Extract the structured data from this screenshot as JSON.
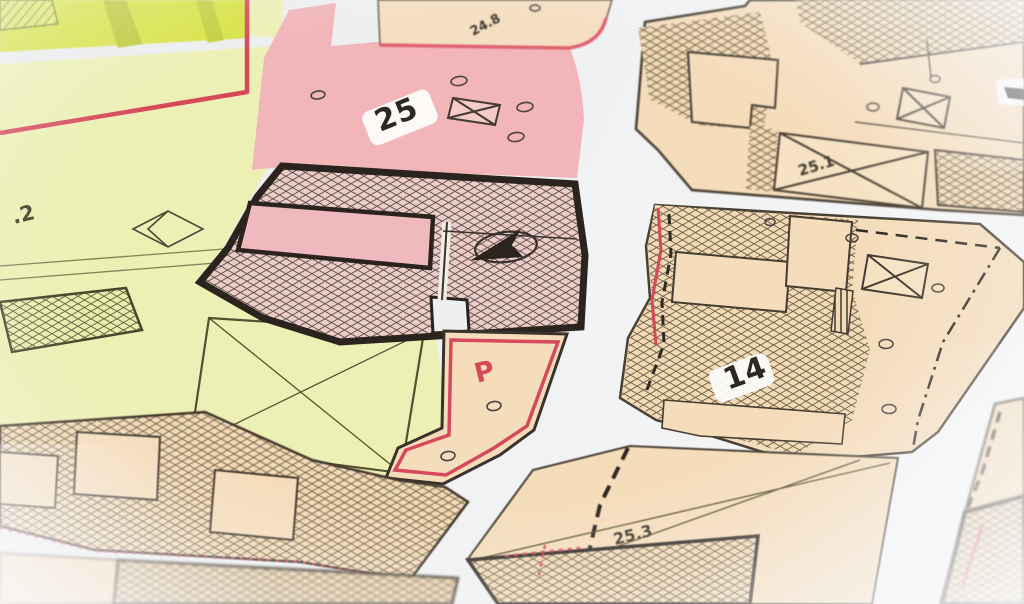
{
  "map": {
    "labels": {
      "parcel_25": "25",
      "parcel_14": "14",
      "parcel_25_1": "25.1",
      "parcel_25_3": "25.3",
      "parcel_24_8": "24.8",
      "parcel_partial_left": ".2",
      "parking": "P"
    },
    "colors": {
      "boundary_red": "#d6495b",
      "outline_dark": "#2b241e",
      "parcel_pink": "#f2b6ba",
      "parcel_yellow_green": "#edf0b4",
      "parcel_chartreuse": "#d7e23f",
      "parcel_beige": "#f5ddbc",
      "street_white": "#eff0f1"
    },
    "symbols": [
      "box-x",
      "diamond",
      "north-arrow",
      "point-circle",
      "dashed-boundary",
      "red-dotted-boundary"
    ]
  }
}
